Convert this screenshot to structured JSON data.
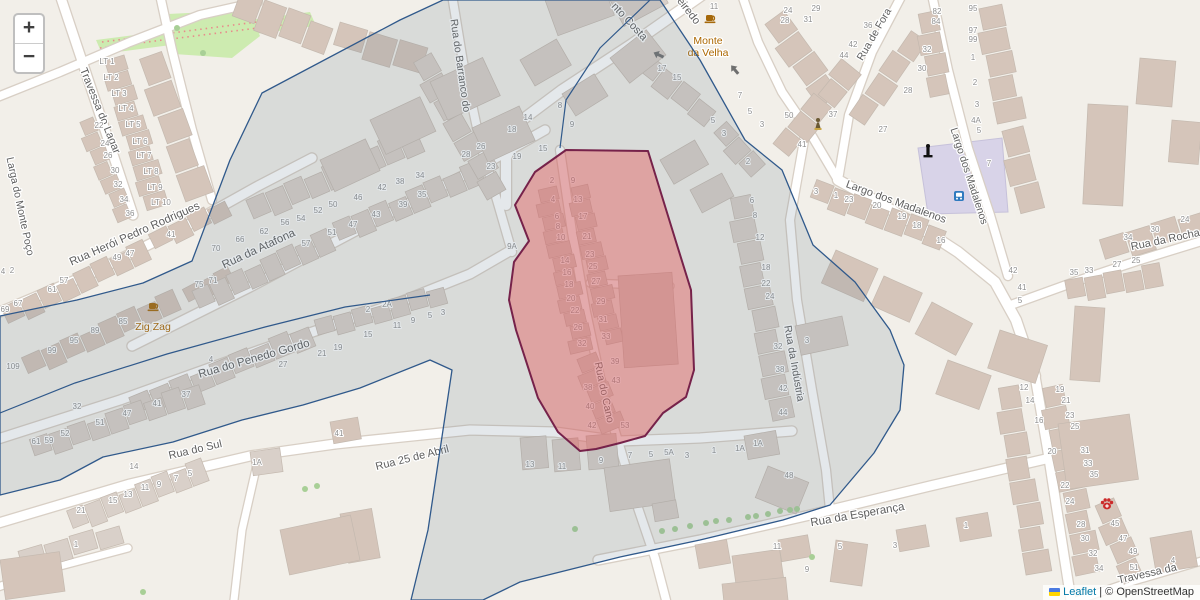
{
  "map": {
    "width": 1200,
    "height": 600,
    "colors": {
      "background": "#f2efe9",
      "road_fill": "#ffffff",
      "road_casing": "#d8cfc5",
      "building_gray": "#d9d0c9",
      "building_tan": "#d5c5ba",
      "building_stroke": "#c4b9af",
      "green_area": "#cdebb0",
      "orchard_dot": "#e88b8b",
      "square_area": "#d8d3e8",
      "street_label": "#5e5e5e",
      "house_number": "#8f8f8f",
      "poi_label": "#ac6700",
      "tree": "#a8cf96",
      "boundary_region_stroke": "#30598b",
      "boundary_region_fill": "rgba(108,125,142,0.18)",
      "highlight_region_stroke": "#76224a",
      "highlight_region_fill": "rgba(228,96,96,0.45)"
    }
  },
  "regions": {
    "boundary_points": "443,0 660,0 700,60 745,140 782,170 813,245 855,282 890,330 904,365 900,410 874,453 830,505 783,520 700,540 620,557 520,582 483,600 411,600 428,530 440,450 452,370 430,360 360,388 303,405 242,420 173,442 103,457 60,480 0,495 0,316 77,300 143,283 192,261 230,160 262,93 400,20",
    "highlight_points": "566,150 648,151 677,245 691,290 694,370 686,397 663,413 645,436 620,443 596,449 580,451 558,432 538,398 516,330 509,300 514,262 529,241 515,205 535,172",
    "inner_lines": [
      "0,413 75,383 167,354 265,327 345,307 430,295",
      "650,0 600,48 566,100 560,148"
    ]
  },
  "street_labels": [
    {
      "t": "Travessa do Lagar",
      "x": 97,
      "y": 112,
      "r": 68,
      "s": 11
    },
    {
      "t": "Larga do Monte Poço",
      "x": 17,
      "y": 207,
      "r": 78,
      "s": 10.5
    },
    {
      "t": "Rua Herói Pedro Rodrigues",
      "x": 136,
      "y": 237,
      "r": -24,
      "s": 11.5
    },
    {
      "t": "Rua da Atafona",
      "x": 260,
      "y": 252,
      "r": -25,
      "s": 11.5
    },
    {
      "t": "Rua do Penedo Gordo",
      "x": 255,
      "y": 362,
      "r": -16,
      "s": 11.5
    },
    {
      "t": "Rua do Sul",
      "x": 196,
      "y": 453,
      "r": -13,
      "s": 11
    },
    {
      "t": "Rua 25 de Abril",
      "x": 413,
      "y": 461,
      "r": -14,
      "s": 11
    },
    {
      "t": "Rua da Esperança",
      "x": 858,
      "y": 518,
      "r": -10,
      "s": 11.5
    },
    {
      "t": "Rua do Cano",
      "x": 601,
      "y": 393,
      "r": 78,
      "s": 10.5
    },
    {
      "t": "Rua do Barranco do",
      "x": 457,
      "y": 66,
      "r": 82,
      "s": 10.5
    },
    {
      "t": "nto Costa",
      "x": 627,
      "y": 24,
      "r": 47,
      "s": 11
    },
    {
      "t": "eiredo",
      "x": 686,
      "y": 13,
      "r": 52,
      "s": 11
    },
    {
      "t": "Rua de Fora",
      "x": 877,
      "y": 36,
      "r": -60,
      "s": 10.5
    },
    {
      "t": "Largo dos Madalenos",
      "x": 895,
      "y": 205,
      "r": 20,
      "s": 11
    },
    {
      "t": "Largo dos Madalenos",
      "x": 966,
      "y": 177,
      "r": 72,
      "s": 10.5
    },
    {
      "t": "Rua da Indústria",
      "x": 791,
      "y": 364,
      "r": 80,
      "s": 10.5
    },
    {
      "t": "Rua da Rocha",
      "x": 1166,
      "y": 243,
      "r": -12,
      "s": 11
    },
    {
      "t": "Travessa da",
      "x": 1148,
      "y": 577,
      "r": -13,
      "s": 11
    }
  ],
  "pois": [
    {
      "name": "cafe-zig-zag",
      "label_lines": [
        "Zig Zag"
      ],
      "x": 153,
      "y": 330,
      "icon_x": 153,
      "icon_y": 306
    },
    {
      "name": "cafe-monte-da-velha",
      "label_lines": [
        "Monte",
        "da Velha"
      ],
      "x": 708,
      "y": 44,
      "icon_x": 710,
      "icon_y": 18
    }
  ],
  "map_icons": [
    {
      "name": "monument-icon",
      "x": 928,
      "y": 152
    },
    {
      "name": "bus-stop-icon",
      "x": 959,
      "y": 196
    },
    {
      "name": "statue-icon",
      "x": 818,
      "y": 124
    },
    {
      "name": "paw-icon",
      "x": 1107,
      "y": 504
    },
    {
      "name": "oneway-arrow",
      "x": 659,
      "y": 55,
      "r": 205
    },
    {
      "name": "oneway-arrow",
      "x": 735,
      "y": 70,
      "r": 230
    }
  ],
  "house_numbers": [
    [
      107,
      64,
      "LT 1"
    ],
    [
      111,
      80,
      "LT 2"
    ],
    [
      119,
      96,
      "LT 3"
    ],
    [
      126,
      111,
      "LT 4"
    ],
    [
      133,
      127,
      "LT 5"
    ],
    [
      140,
      144,
      "LT 6"
    ],
    [
      144,
      158,
      "LT 7"
    ],
    [
      151,
      174,
      "LT 8"
    ],
    [
      155,
      190,
      "LT 9"
    ],
    [
      161,
      205,
      "LT 10"
    ],
    [
      99,
      128,
      "22"
    ],
    [
      105,
      146,
      "24"
    ],
    [
      108,
      158,
      "26"
    ],
    [
      115,
      173,
      "30"
    ],
    [
      118,
      187,
      "32"
    ],
    [
      124,
      202,
      "34"
    ],
    [
      130,
      216,
      "36"
    ],
    [
      171,
      237,
      "41"
    ],
    [
      130,
      256,
      "47"
    ],
    [
      117,
      260,
      "49"
    ],
    [
      64,
      283,
      "57"
    ],
    [
      52,
      292,
      "61"
    ],
    [
      18,
      306,
      "67"
    ],
    [
      5,
      312,
      "69"
    ],
    [
      123,
      324,
      "85"
    ],
    [
      95,
      333,
      "89"
    ],
    [
      74,
      343,
      "95"
    ],
    [
      52,
      353,
      "99"
    ],
    [
      13,
      369,
      "109"
    ],
    [
      12,
      273,
      "2"
    ],
    [
      3,
      274,
      "4"
    ],
    [
      216,
      251,
      "70"
    ],
    [
      240,
      242,
      "66"
    ],
    [
      264,
      234,
      "62"
    ],
    [
      285,
      225,
      "56"
    ],
    [
      301,
      221,
      "54"
    ],
    [
      318,
      213,
      "52"
    ],
    [
      333,
      207,
      "50"
    ],
    [
      358,
      200,
      "46"
    ],
    [
      382,
      190,
      "42"
    ],
    [
      400,
      184,
      "38"
    ],
    [
      420,
      178,
      "34"
    ],
    [
      422,
      197,
      "35"
    ],
    [
      403,
      207,
      "39"
    ],
    [
      376,
      217,
      "43"
    ],
    [
      353,
      227,
      "47"
    ],
    [
      332,
      235,
      "51"
    ],
    [
      306,
      246,
      "57"
    ],
    [
      199,
      287,
      "75"
    ],
    [
      213,
      283,
      "71"
    ],
    [
      368,
      312,
      "2"
    ],
    [
      387,
      307,
      "2A"
    ],
    [
      397,
      328,
      "11"
    ],
    [
      413,
      323,
      "9"
    ],
    [
      430,
      318,
      "5"
    ],
    [
      443,
      315,
      "3"
    ],
    [
      368,
      337,
      "15"
    ],
    [
      338,
      350,
      "19"
    ],
    [
      322,
      356,
      "21"
    ],
    [
      283,
      367,
      "27"
    ],
    [
      211,
      362,
      "4"
    ],
    [
      186,
      397,
      "37"
    ],
    [
      157,
      406,
      "41"
    ],
    [
      127,
      416,
      "47"
    ],
    [
      100,
      425,
      "51"
    ],
    [
      65,
      436,
      "52"
    ],
    [
      49,
      443,
      "59"
    ],
    [
      36,
      444,
      "61"
    ],
    [
      77,
      409,
      "32"
    ],
    [
      134,
      469,
      "14"
    ],
    [
      190,
      476,
      "5"
    ],
    [
      176,
      481,
      "7"
    ],
    [
      159,
      487,
      "9"
    ],
    [
      145,
      490,
      "11"
    ],
    [
      128,
      497,
      "13"
    ],
    [
      113,
      503,
      "15"
    ],
    [
      81,
      513,
      "21"
    ],
    [
      76,
      547,
      "1"
    ],
    [
      257,
      465,
      "1A"
    ],
    [
      339,
      436,
      "41"
    ],
    [
      560,
      108,
      "8"
    ],
    [
      528,
      120,
      "14"
    ],
    [
      512,
      132,
      "18"
    ],
    [
      572,
      127,
      "9"
    ],
    [
      543,
      151,
      "15"
    ],
    [
      517,
      159,
      "19"
    ],
    [
      491,
      169,
      "23"
    ],
    [
      481,
      149,
      "26"
    ],
    [
      466,
      157,
      "28"
    ],
    [
      512,
      249,
      "9A"
    ],
    [
      552,
      183,
      "2"
    ],
    [
      553,
      202,
      "4"
    ],
    [
      557,
      219,
      "6"
    ],
    [
      558,
      229,
      "8"
    ],
    [
      561,
      240,
      "10"
    ],
    [
      565,
      263,
      "14"
    ],
    [
      567,
      275,
      "16"
    ],
    [
      569,
      287,
      "18"
    ],
    [
      571,
      301,
      "20"
    ],
    [
      575,
      313,
      "22"
    ],
    [
      578,
      330,
      "26"
    ],
    [
      582,
      346,
      "32"
    ],
    [
      588,
      390,
      "38"
    ],
    [
      590,
      409,
      "40"
    ],
    [
      592,
      428,
      "42"
    ],
    [
      573,
      183,
      "9"
    ],
    [
      578,
      202,
      "13"
    ],
    [
      583,
      219,
      "17"
    ],
    [
      587,
      239,
      "21"
    ],
    [
      590,
      257,
      "23"
    ],
    [
      593,
      269,
      "25"
    ],
    [
      596,
      284,
      "27"
    ],
    [
      601,
      304,
      "29"
    ],
    [
      603,
      322,
      "31"
    ],
    [
      606,
      339,
      "33"
    ],
    [
      615,
      364,
      "39"
    ],
    [
      616,
      383,
      "43"
    ],
    [
      625,
      428,
      "53"
    ],
    [
      662,
      71,
      "17"
    ],
    [
      677,
      80,
      "15"
    ],
    [
      740,
      98,
      "7"
    ],
    [
      750,
      114,
      "5"
    ],
    [
      762,
      127,
      "3"
    ],
    [
      789,
      118,
      "50"
    ],
    [
      713,
      123,
      "5"
    ],
    [
      724,
      136,
      "3"
    ],
    [
      802,
      147,
      "41"
    ],
    [
      714,
      9,
      "11"
    ],
    [
      788,
      13,
      "24"
    ],
    [
      785,
      23,
      "28"
    ],
    [
      748,
      164,
      "2"
    ],
    [
      816,
      11,
      "29"
    ],
    [
      808,
      22,
      "31"
    ],
    [
      868,
      28,
      "36"
    ],
    [
      853,
      47,
      "42"
    ],
    [
      844,
      58,
      "44"
    ],
    [
      937,
      14,
      "82"
    ],
    [
      936,
      24,
      "84"
    ],
    [
      927,
      52,
      "32"
    ],
    [
      922,
      71,
      "30"
    ],
    [
      908,
      93,
      "28"
    ],
    [
      833,
      117,
      "37"
    ],
    [
      883,
      132,
      "27"
    ],
    [
      973,
      11,
      "95"
    ],
    [
      973,
      33,
      "97"
    ],
    [
      973,
      42,
      "99"
    ],
    [
      973,
      60,
      "1"
    ],
    [
      975,
      85,
      "2"
    ],
    [
      977,
      107,
      "3"
    ],
    [
      976,
      123,
      "4A"
    ],
    [
      979,
      133,
      "5"
    ],
    [
      989,
      166,
      "7"
    ],
    [
      816,
      194,
      "3"
    ],
    [
      836,
      198,
      "1"
    ],
    [
      849,
      202,
      "23"
    ],
    [
      877,
      208,
      "20"
    ],
    [
      902,
      219,
      "19"
    ],
    [
      917,
      228,
      "18"
    ],
    [
      941,
      243,
      "16"
    ],
    [
      1013,
      273,
      "42"
    ],
    [
      1022,
      290,
      "41"
    ],
    [
      1020,
      303,
      "5"
    ],
    [
      752,
      203,
      "6"
    ],
    [
      755,
      218,
      "8"
    ],
    [
      760,
      240,
      "12"
    ],
    [
      766,
      270,
      "18"
    ],
    [
      766,
      286,
      "22"
    ],
    [
      770,
      299,
      "24"
    ],
    [
      778,
      349,
      "32"
    ],
    [
      780,
      372,
      "38"
    ],
    [
      783,
      391,
      "42"
    ],
    [
      783,
      415,
      "44"
    ],
    [
      807,
      343,
      "3"
    ],
    [
      758,
      446,
      "1A"
    ],
    [
      789,
      478,
      "48"
    ],
    [
      530,
      467,
      "13"
    ],
    [
      562,
      469,
      "11"
    ],
    [
      601,
      463,
      "9"
    ],
    [
      630,
      458,
      "7"
    ],
    [
      651,
      457,
      "5"
    ],
    [
      669,
      455,
      "5A"
    ],
    [
      687,
      458,
      "3"
    ],
    [
      714,
      453,
      "1"
    ],
    [
      740,
      451,
      "1A"
    ],
    [
      777,
      549,
      "11"
    ],
    [
      840,
      549,
      "5"
    ],
    [
      807,
      572,
      "9"
    ],
    [
      895,
      548,
      "3"
    ],
    [
      1024,
      390,
      "12"
    ],
    [
      1030,
      403,
      "14"
    ],
    [
      1039,
      423,
      "16"
    ],
    [
      1060,
      392,
      "19"
    ],
    [
      1066,
      403,
      "21"
    ],
    [
      1070,
      418,
      "23"
    ],
    [
      1075,
      429,
      "25"
    ],
    [
      1052,
      454,
      "20"
    ],
    [
      1085,
      453,
      "31"
    ],
    [
      1088,
      466,
      "33"
    ],
    [
      1094,
      477,
      "35"
    ],
    [
      1065,
      488,
      "22"
    ],
    [
      1070,
      504,
      "24"
    ],
    [
      1081,
      527,
      "28"
    ],
    [
      1085,
      541,
      "30"
    ],
    [
      1093,
      556,
      "32"
    ],
    [
      1099,
      571,
      "34"
    ],
    [
      1115,
      526,
      "45"
    ],
    [
      1123,
      541,
      "47"
    ],
    [
      1133,
      554,
      "49"
    ],
    [
      1134,
      570,
      "51"
    ],
    [
      966,
      528,
      "1"
    ],
    [
      1173,
      563,
      "4"
    ],
    [
      1128,
      240,
      "34"
    ],
    [
      1155,
      232,
      "30"
    ],
    [
      1185,
      222,
      "24"
    ],
    [
      1117,
      267,
      "27"
    ],
    [
      1136,
      263,
      "25"
    ],
    [
      1074,
      275,
      "35"
    ],
    [
      1089,
      273,
      "33"
    ]
  ],
  "controls": {
    "zoom_in": "+",
    "zoom_out": "−"
  },
  "attribution": {
    "leaflet": "Leaflet",
    "separator": " | ",
    "copyright": "© OpenStreetMap",
    "link_color": "#0078A8",
    "flag_colors": [
      "#4C7BE1",
      "#FFD500"
    ]
  }
}
